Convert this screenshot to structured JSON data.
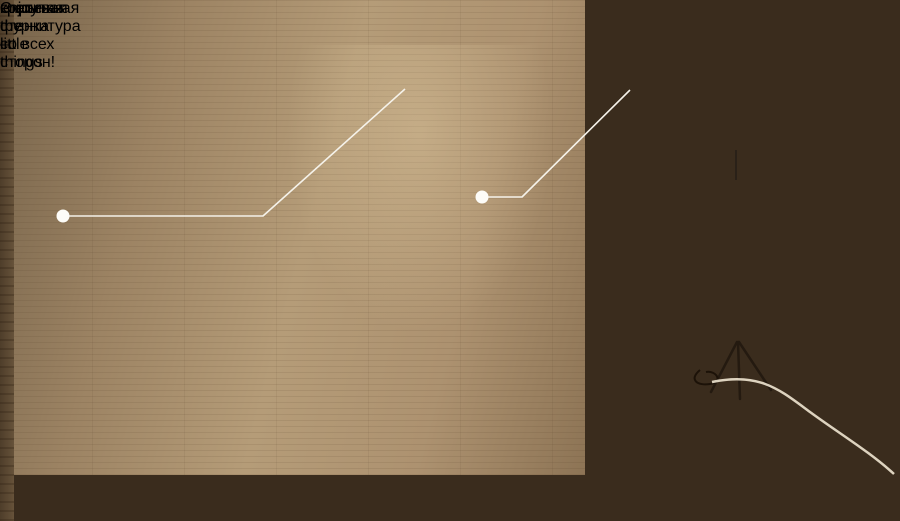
{
  "headline": {
    "bold_lead": "Скрытая",
    "light_rest": "крепежная фурнитура –",
    "line2": "красивая стенка со всех сторон!"
  },
  "posters": {
    "script_text": "enjoy the little things"
  },
  "palette": {
    "wood_wall": "#b0946f",
    "painted_wall_dark": "#1d130a",
    "warm_glow": "#f6dcae",
    "cabinet_white": "#ccd4d7",
    "bench_white": "#efeee8",
    "rug_yellow": "#d4b83b",
    "headline_white": "#ffffff",
    "headline_muted": "#d7cfc5",
    "callout_line": "#f5f2ea"
  }
}
